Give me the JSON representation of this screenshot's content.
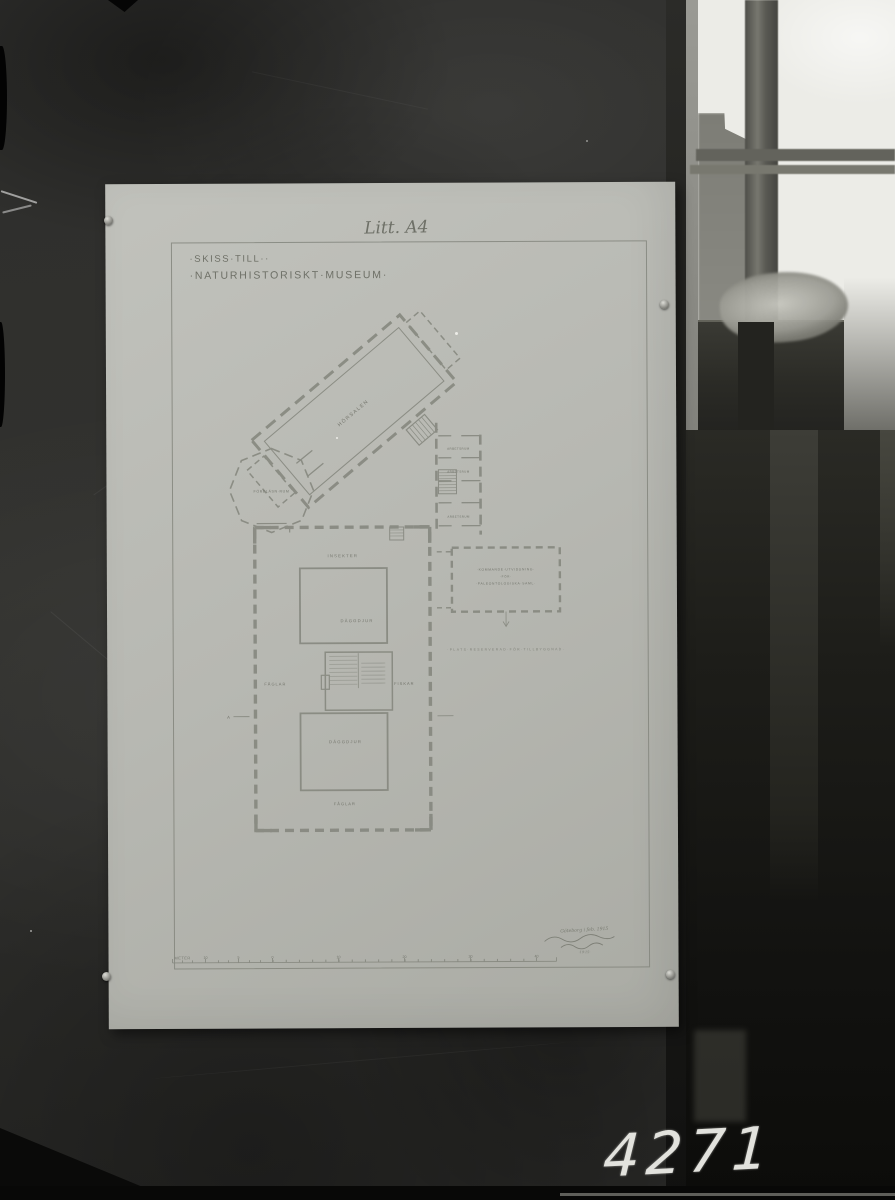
{
  "photo": {
    "catalog_number": "4271"
  },
  "sheet": {
    "litt_label": "Litt. A4",
    "subtitle_line1": "·SKISS·TILL··",
    "subtitle_line2": "·NATURHISTORISKT·MUSEUM·",
    "plan": {
      "hall_label": "HÖRSALEN",
      "octagon_label": "FÖRELÄSN·RUM",
      "side_room_1": "ARBETSRUM",
      "side_room_2": "ARBETSRUM",
      "side_room_3": "ARBETSRUM",
      "entrance_label": "INSEKTER",
      "upper_court_label": "DÄGGDJUR",
      "west_gallery_label": "FÅGLAR",
      "east_gallery_label": "FISKAR",
      "lower_court_label": "DÄGGDJUR",
      "south_gallery_label": "FÅGLAR",
      "section_mark": "A",
      "annex_line_1": "·KOMMANDE·UTVIDGNING·",
      "annex_line_2": "·FÖR·",
      "annex_line_3": "·PALEONTOLOGISKA·SAML·",
      "reserved_note": "·PLATS·RESERVERAD·FÖR·TILLBYGGNAD·"
    },
    "scale_bar": {
      "unit_label": "METER",
      "tick_labels": [
        "10",
        "5",
        "0",
        "10",
        "20",
        "30",
        "40"
      ]
    },
    "signature": {
      "line1": "Göteborg i feb. 1915",
      "line2": "·19·15·"
    }
  }
}
